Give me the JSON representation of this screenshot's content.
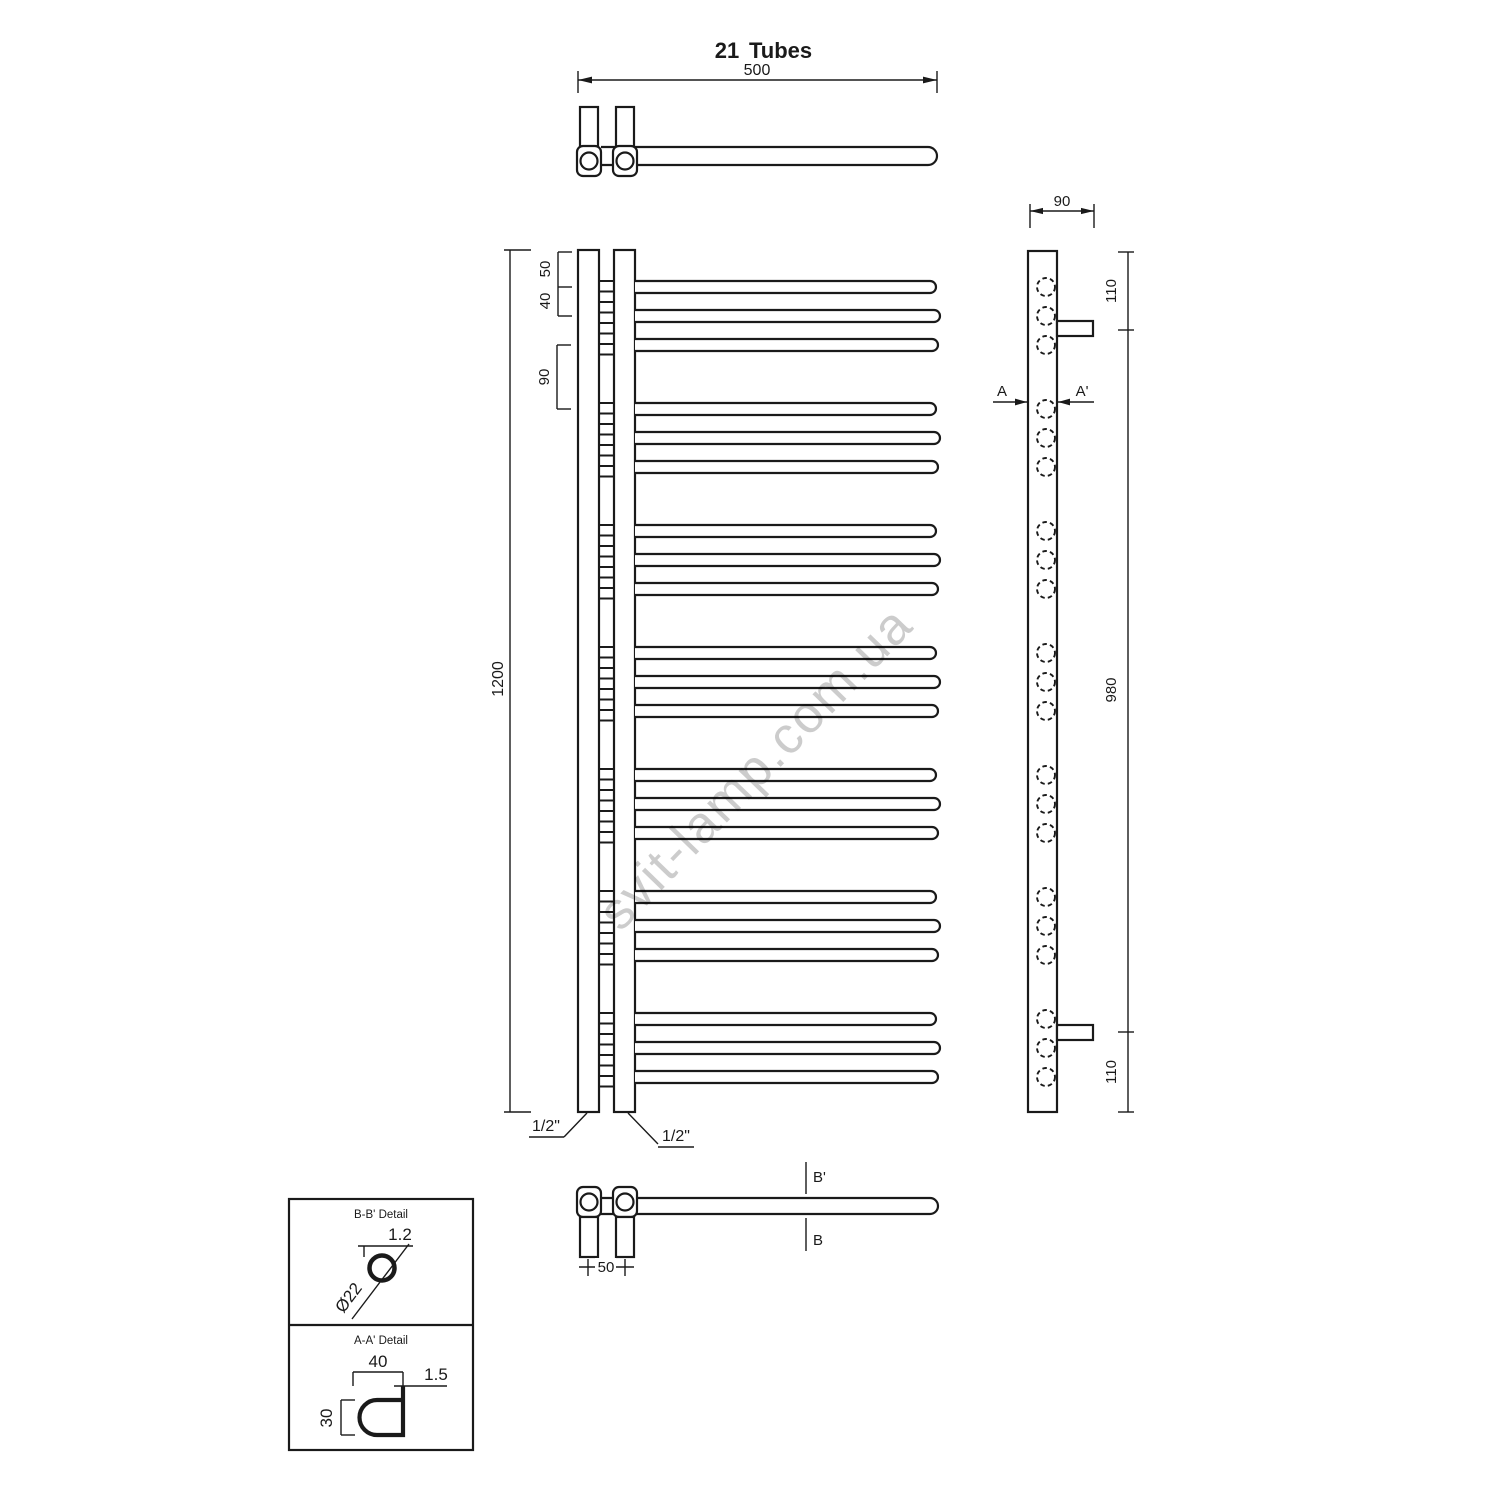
{
  "drawing": {
    "title_number": "21",
    "title_word": "Tubes",
    "tube_count": 21,
    "tube_groups": 7,
    "tubes_per_group": 3,
    "watermark": "svit-lamp.com.ua",
    "line_color": "#1a1a1a",
    "watermark_color": "rgba(0,0,0,0.20)"
  },
  "top_view": {
    "overall_width": "500"
  },
  "front_view": {
    "top_offset": "50",
    "tube_pitch": "40",
    "group_gap": "90",
    "overall_height": "1200",
    "left_connection": "1/2\"",
    "right_connection": "1/2\""
  },
  "side_view": {
    "depth": "90",
    "top_bracket_offset": "110",
    "bracket_span": "980",
    "bottom_bracket_offset": "110",
    "section_label_left": "A",
    "section_label_right": "A'"
  },
  "bottom_view": {
    "connection_pitch": "50",
    "section_label_top": "B'",
    "section_label_bottom": "B"
  },
  "detail_panel": {
    "bb_title": "B-B' Detail",
    "tube_wall": "1.2",
    "tube_diameter": "Ø22",
    "aa_title": "A-A' Detail",
    "rail_width": "40",
    "rail_wall": "1.5",
    "rail_height": "30"
  }
}
